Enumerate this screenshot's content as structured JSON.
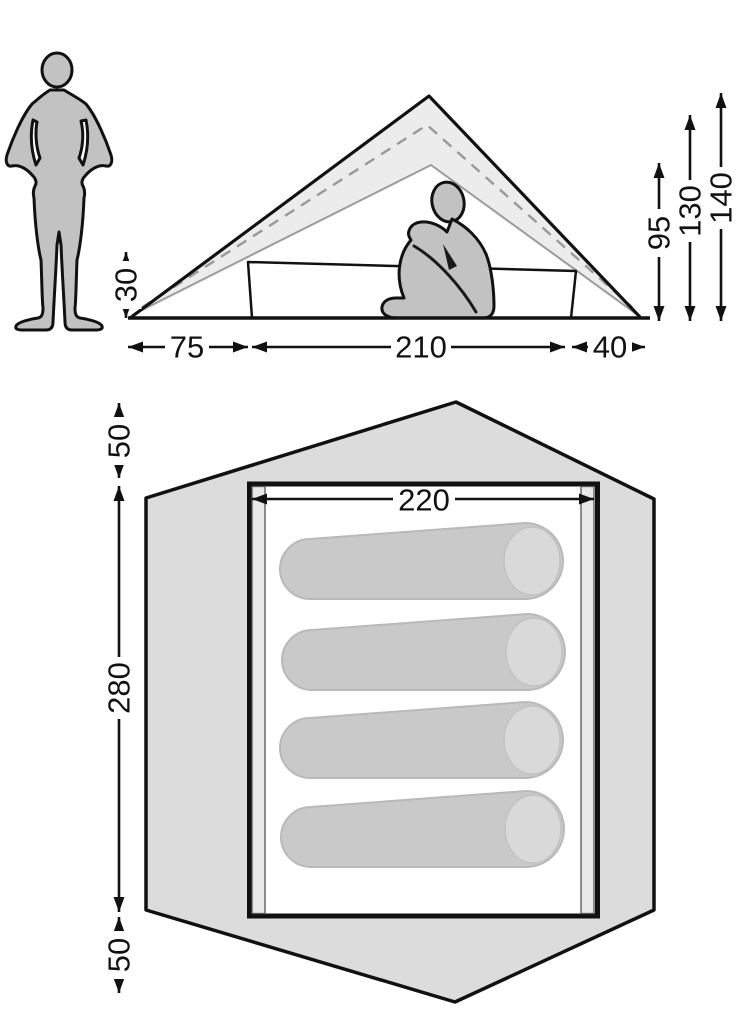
{
  "side_view": {
    "dims": {
      "edge_height": "30",
      "porch_depth": "75",
      "inner_length": "210",
      "rear_depth": "40",
      "inner_height": "95",
      "mid_height": "130",
      "peak_height": "140"
    }
  },
  "floor_plan": {
    "dims": {
      "top_canopy": "50",
      "inner_length": "280",
      "bottom_canopy": "50",
      "inner_width": "220"
    },
    "sleeping_bag_count": 4
  },
  "colors": {
    "silhouette_gray": "#c2c2c2",
    "canvas_light_gray": "#ececec",
    "footprint_gray": "#dcdcdc",
    "bag_gray": "#c9c9c9",
    "bag_hood_gray": "#d9d9d9",
    "inner_line_gray": "#9c9c9c",
    "outline_black": "#111111"
  }
}
